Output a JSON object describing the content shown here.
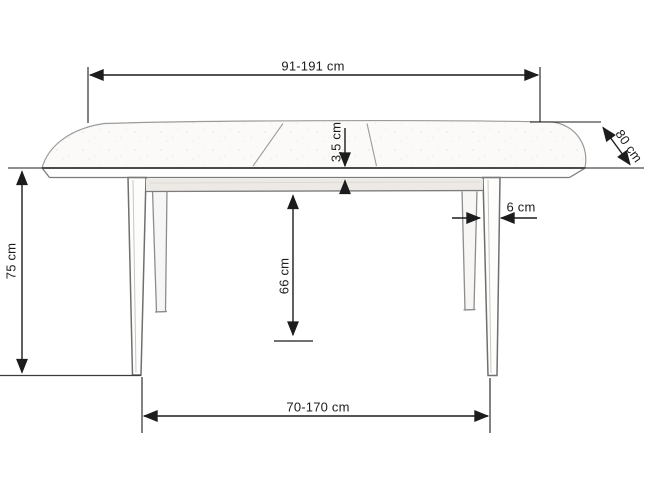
{
  "diagram": {
    "labels": {
      "top_length": "91-191 cm",
      "depth": "80 cm",
      "top_thickness": "3,5 cm",
      "leg_width": "6 cm",
      "underframe_height": "66 cm",
      "overall_height": "75 cm",
      "base_span": "70-170 cm"
    }
  }
}
